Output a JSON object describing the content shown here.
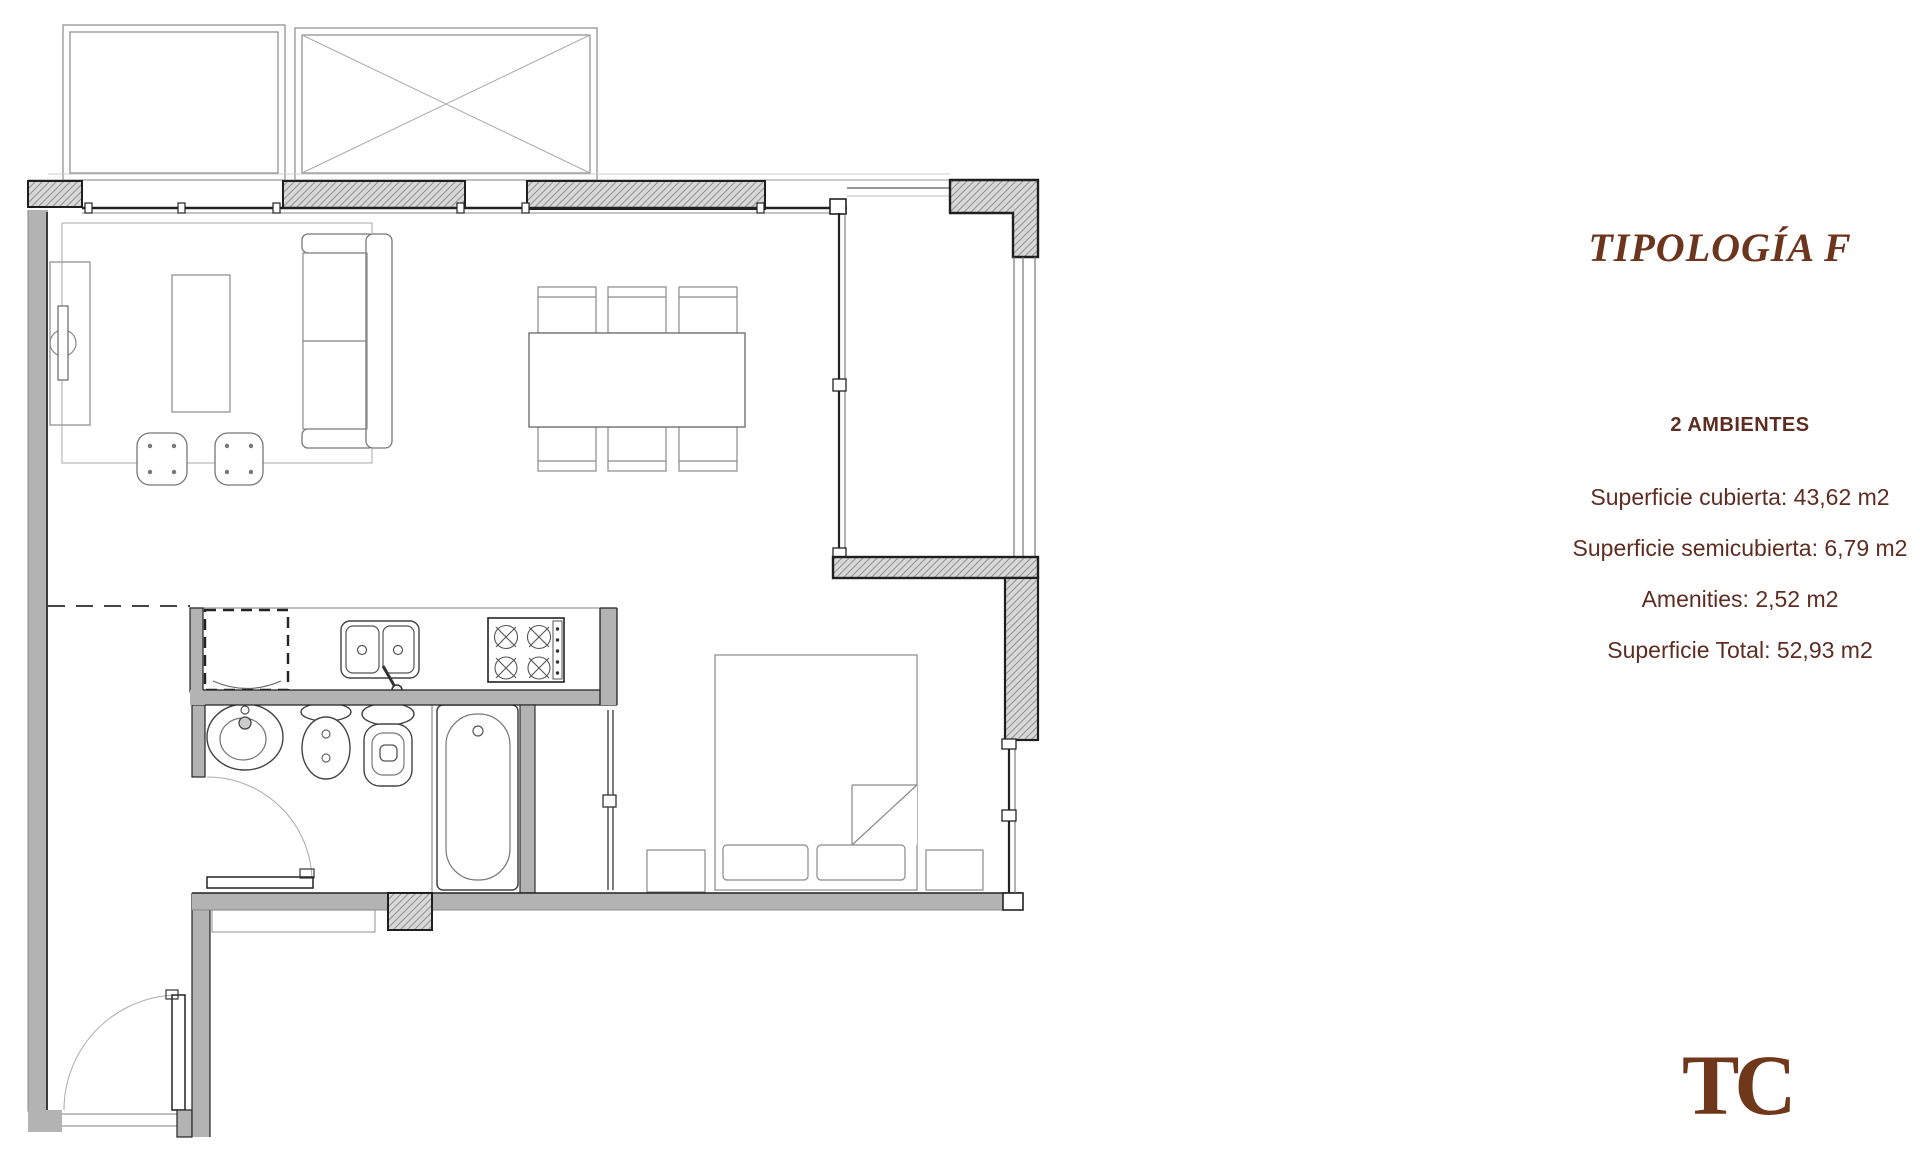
{
  "panel": {
    "title": "TIPOLOGÍA F",
    "subtitle": "2 AMBIENTES",
    "stats": [
      "Superficie cubierta: 43,62 m2",
      "Superficie semicubierta: 6,79 m2",
      "Amenities: 2,52 m2",
      "Superficie Total: 52,93 m2"
    ],
    "logo": "TC"
  },
  "colors": {
    "title_brown": "#6b351e",
    "text_brown": "#5e2d22",
    "logo_brown": "#70381a",
    "wall_gray": "#b3b3b3",
    "hatch_fill": "#d9d9d9",
    "hatch_line": "#9a9a9a",
    "outline_dark": "#1f1f1f",
    "furniture_line": "#8a8a8a"
  },
  "plan": {
    "kind": "apartment floor plan, typology F, 2 rooms",
    "rooms": [
      "living-dining",
      "kitchen",
      "bathroom",
      "bedroom",
      "balcony",
      "entry-hall"
    ]
  }
}
